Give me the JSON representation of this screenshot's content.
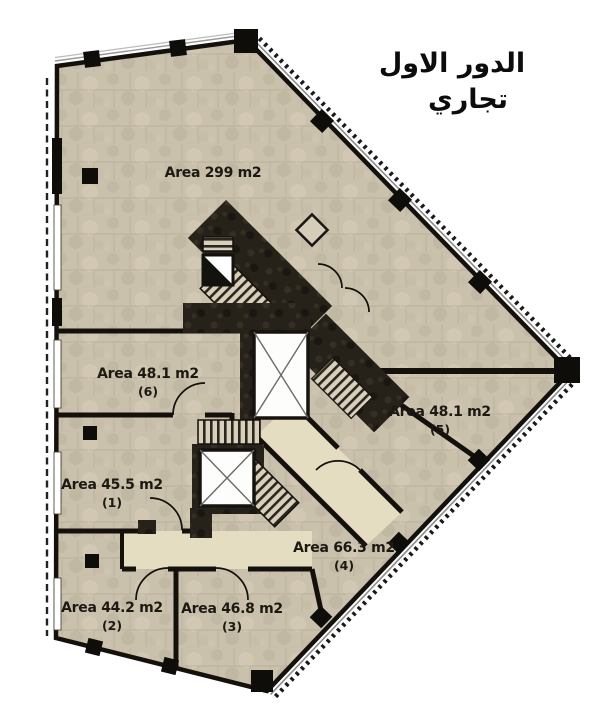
{
  "title": {
    "line1": "الدور الاول",
    "line2": "تجاري"
  },
  "floor_areas": [
    {
      "id": "main-hall",
      "label": "Area 299 m2",
      "number": ""
    },
    {
      "id": "unit-6",
      "label": "Area 48.1 m2",
      "number": "(6)"
    },
    {
      "id": "unit-5",
      "label": "Area 48.1 m2",
      "number": "(5)"
    },
    {
      "id": "unit-1",
      "label": "Area 45.5 m2",
      "number": "(1)"
    },
    {
      "id": "unit-4",
      "label": "Area 66.3 m2",
      "number": "(4)"
    },
    {
      "id": "unit-2",
      "label": "Area 44.2 m2",
      "number": "(2)"
    },
    {
      "id": "unit-3",
      "label": "Area 46.8 m2",
      "number": "(3)"
    }
  ],
  "colors": {
    "floor": "#cac1ad",
    "corridor": "#e5ddc2",
    "wall": "#14110d",
    "core": "#262119",
    "background": "#ffffff"
  }
}
